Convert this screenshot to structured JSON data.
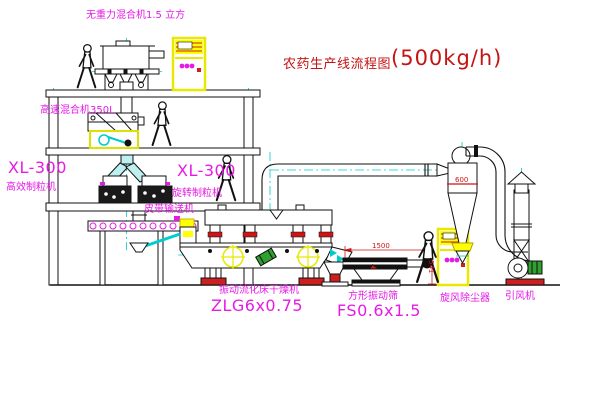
{
  "title": {
    "text": "农药生产线流程图",
    "capacity": "(500kg/h)"
  },
  "labels": {
    "gravity_mixer": "无重力混合机1.5 立方",
    "high_speed_mixer": "高速混合机350L",
    "granulator_left_model": "XL-300",
    "granulator_left_name": "高效制粒机",
    "granulator_mid_model": "XL-300",
    "granulator_mid_name": "旋转制粒机",
    "belt_conveyor": "皮带输送机",
    "dryer_name": "振动流化床干燥机",
    "dryer_model": "ZLG6x0.75",
    "sieve_name": "方形振动筛",
    "sieve_model": "FS0.6x1.5",
    "cyclone": "旋风除尘器",
    "fan": "引风机"
  },
  "dimensions": {
    "sieve_width": "1500",
    "sieve_height": "541",
    "cyclone_diameter": "600"
  },
  "colors": {
    "label_magenta": "#e61ae6",
    "title_red": "#c41414",
    "dimension_red": "#cc1616",
    "cabinet_yellow": "#ffff00",
    "centerline_cyan": "#00cccc",
    "motor_green": "#2fa12f",
    "base_red": "#cc2020",
    "line_black": "#111111"
  }
}
